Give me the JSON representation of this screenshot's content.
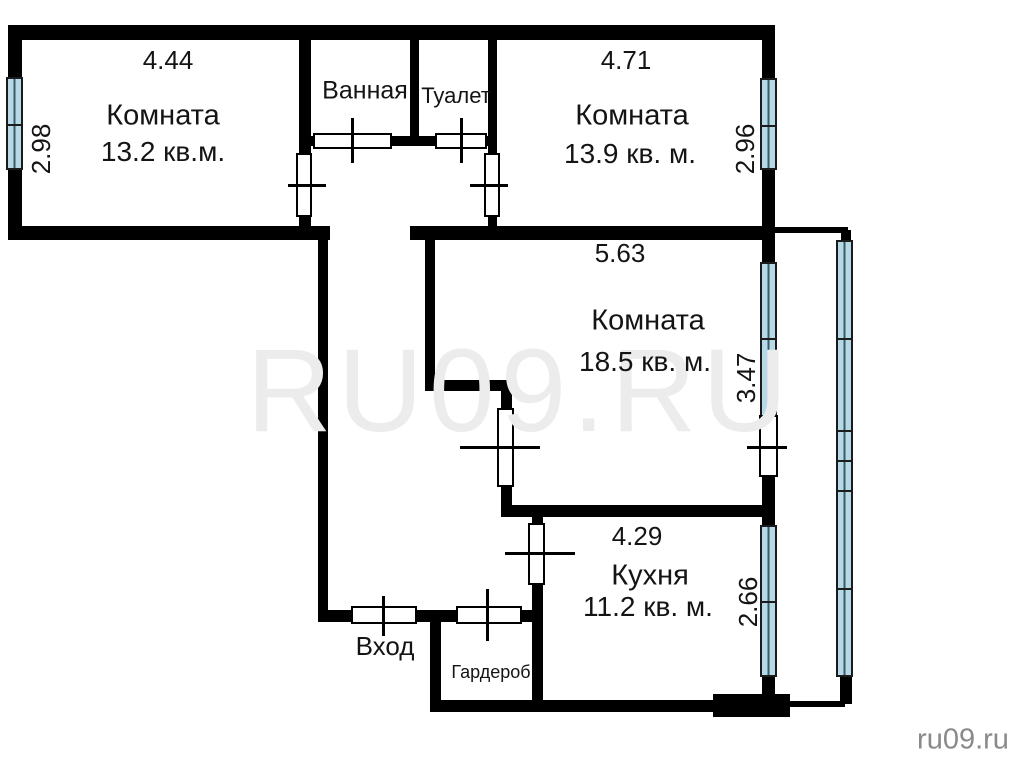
{
  "watermark": "RU09.RU",
  "credit": "ru09.ru",
  "colors": {
    "wall": "#000000",
    "window_fill": "#b5d9e6",
    "watermark": "#ececec",
    "credit": "#8a8a8a",
    "label": "#141414"
  },
  "rooms": {
    "room1": {
      "name": "Комната",
      "area": "13.2 кв.м.",
      "width": "4.44",
      "depth": "2.98"
    },
    "bathroom": {
      "name": "Ванная"
    },
    "toilet": {
      "name": "Туалет"
    },
    "room2": {
      "name": "Комната",
      "area": "13.9 кв. м.",
      "width": "4.71",
      "depth": "2.96"
    },
    "room3": {
      "name": "Комната",
      "area": "18.5 кв. м.",
      "width": "5.63",
      "depth": "3.47"
    },
    "kitchen": {
      "name": "Кухня",
      "area": "11.2 кв. м.",
      "width": "4.29",
      "depth": "2.66"
    },
    "entrance": {
      "name": "Вход"
    },
    "wardrobe": {
      "name": "Гардероб"
    }
  }
}
